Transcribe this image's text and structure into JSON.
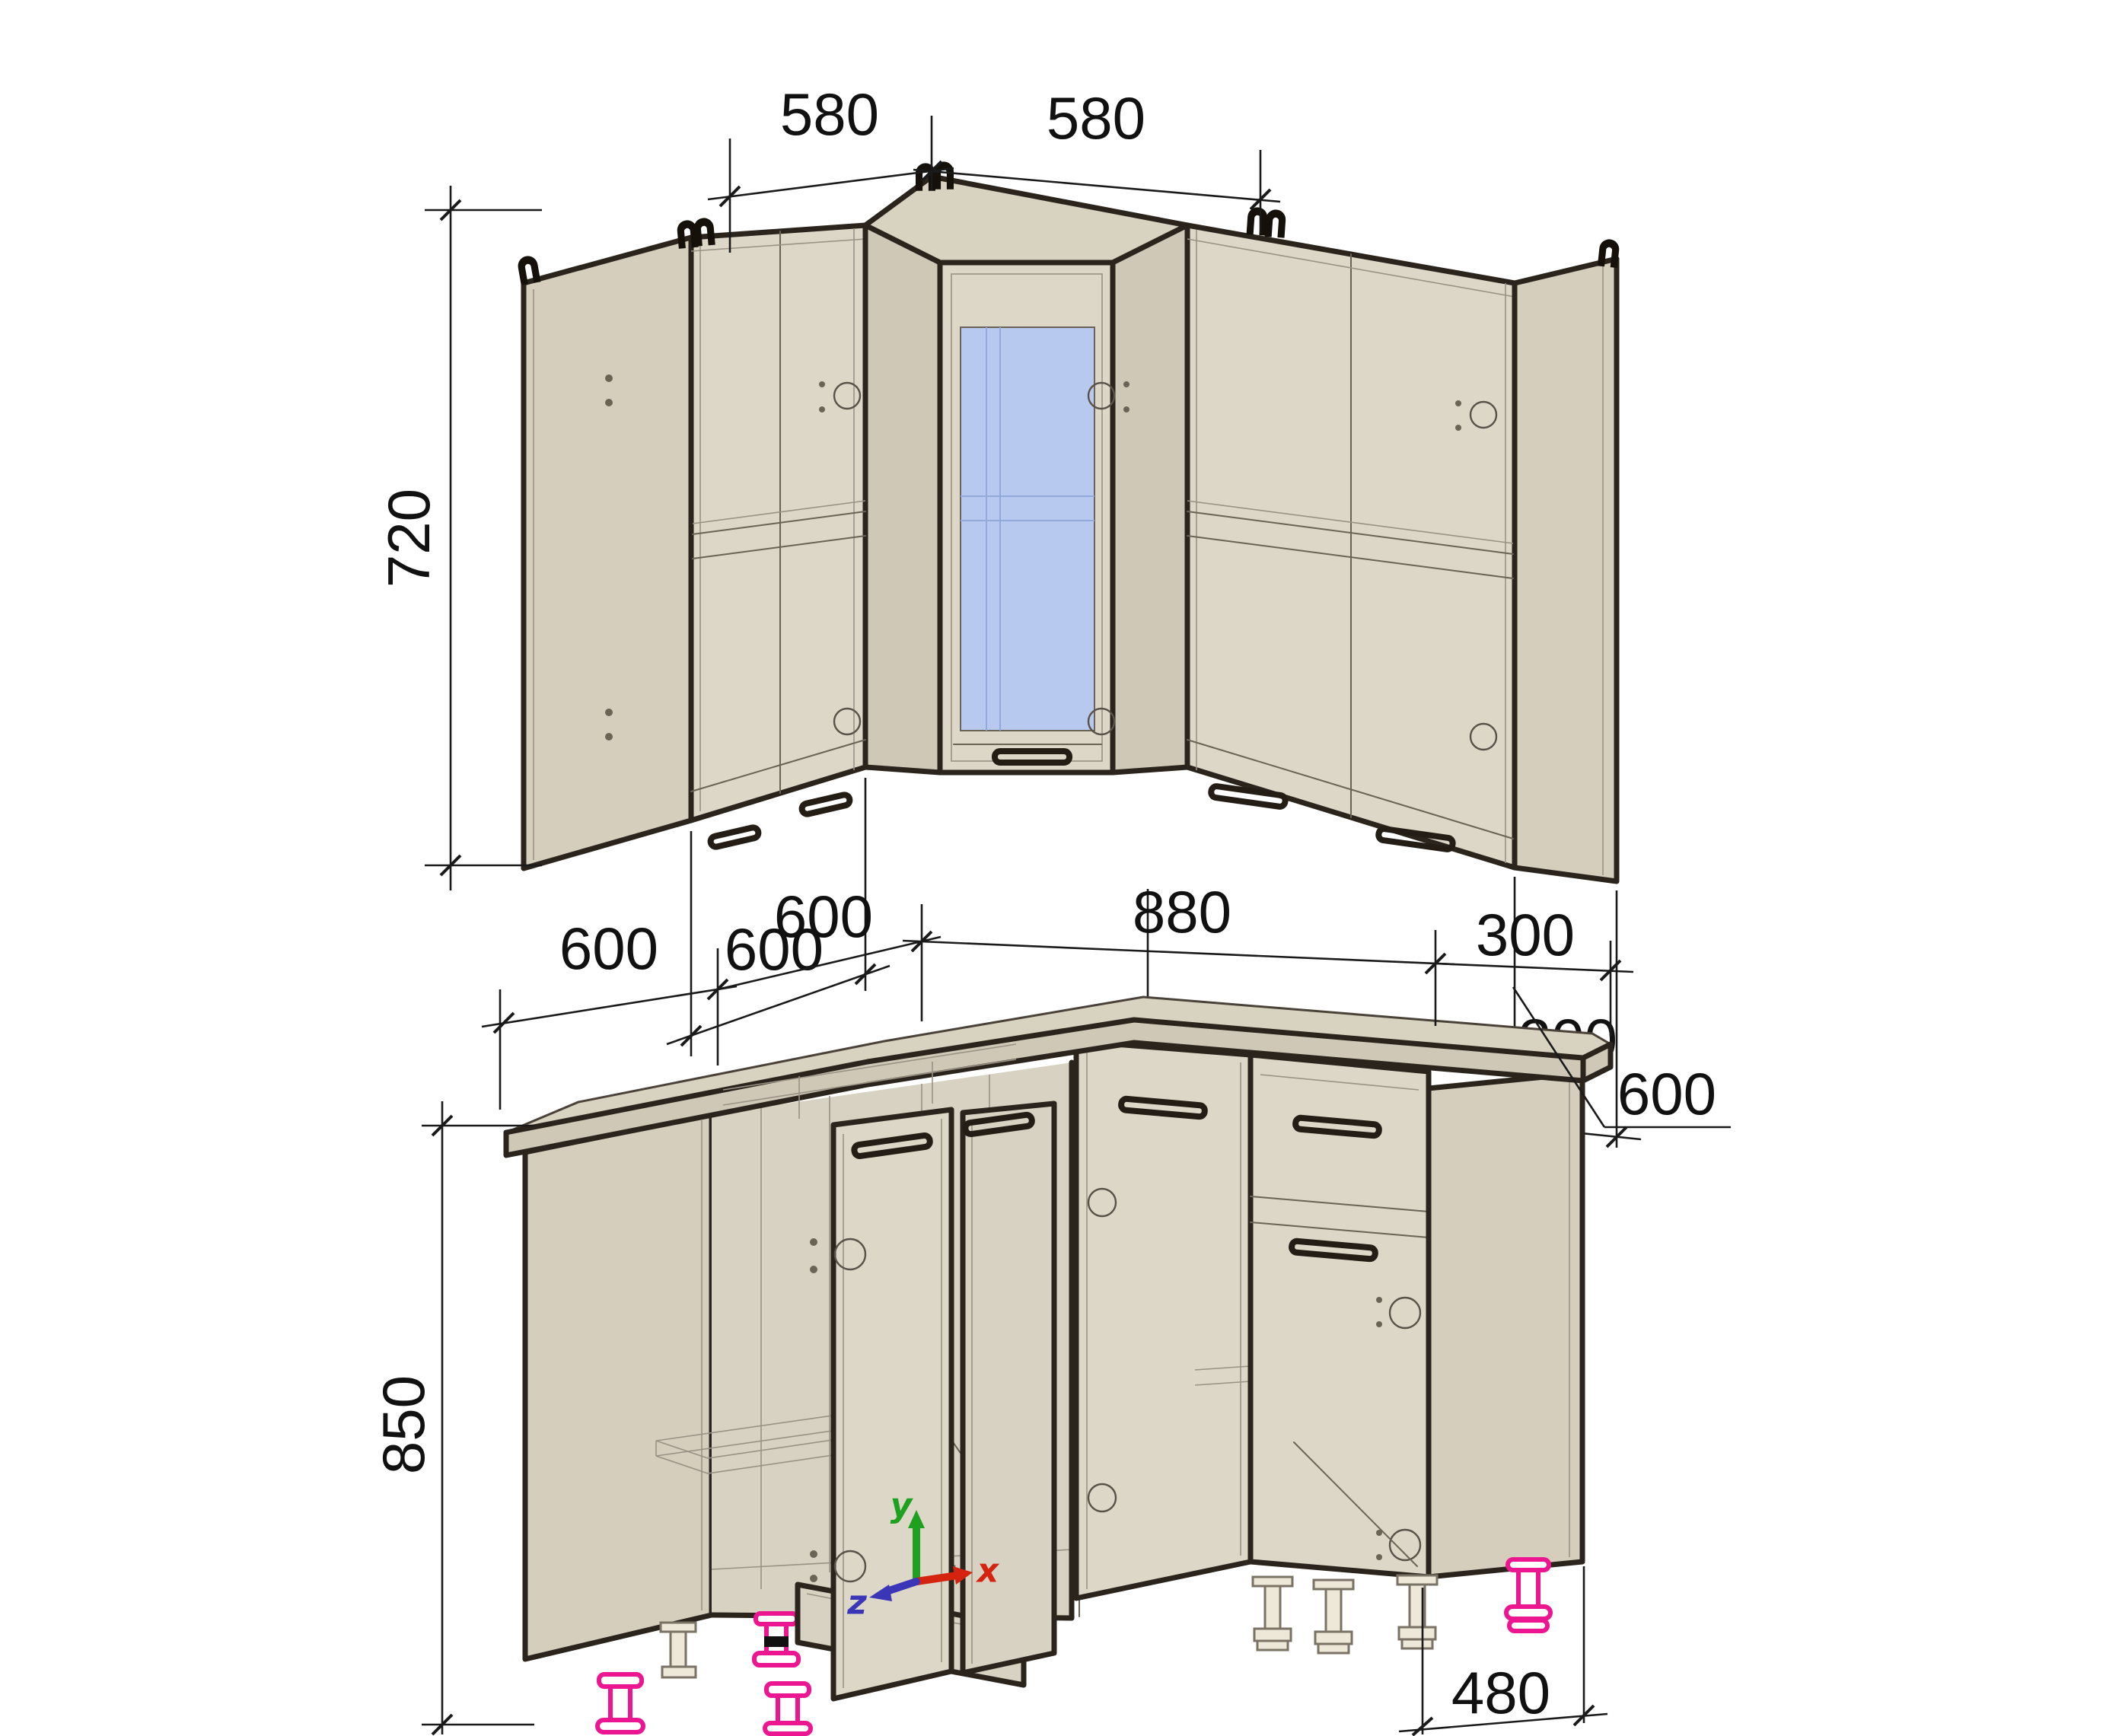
{
  "views": {
    "wall": {
      "label": "wall-cabinets-view",
      "dims": {
        "top_left": "580",
        "top_right": "580",
        "height": "720",
        "bottom_left": "600",
        "bottom_right": "600",
        "bottom_end": "300"
      }
    },
    "base": {
      "label": "base-cabinets-view",
      "dims": {
        "left_1": "600",
        "left_2": "600",
        "right": "880",
        "right_end": "300",
        "depth": "600",
        "height": "850",
        "plinth": "480"
      },
      "axis": {
        "x": "x",
        "y": "y",
        "z": "z"
      }
    }
  },
  "colors": {
    "cabinet_front": "#ddd7c7",
    "cabinet_panel": "#d5cebd",
    "glass": "#b7c9ef",
    "outline": "#2b241d",
    "dimension": "#1a1a1a",
    "leg_accent": "#ec1690",
    "axis_x": "#d42410",
    "axis_y": "#1fa11f",
    "axis_z": "#3b36b8"
  }
}
